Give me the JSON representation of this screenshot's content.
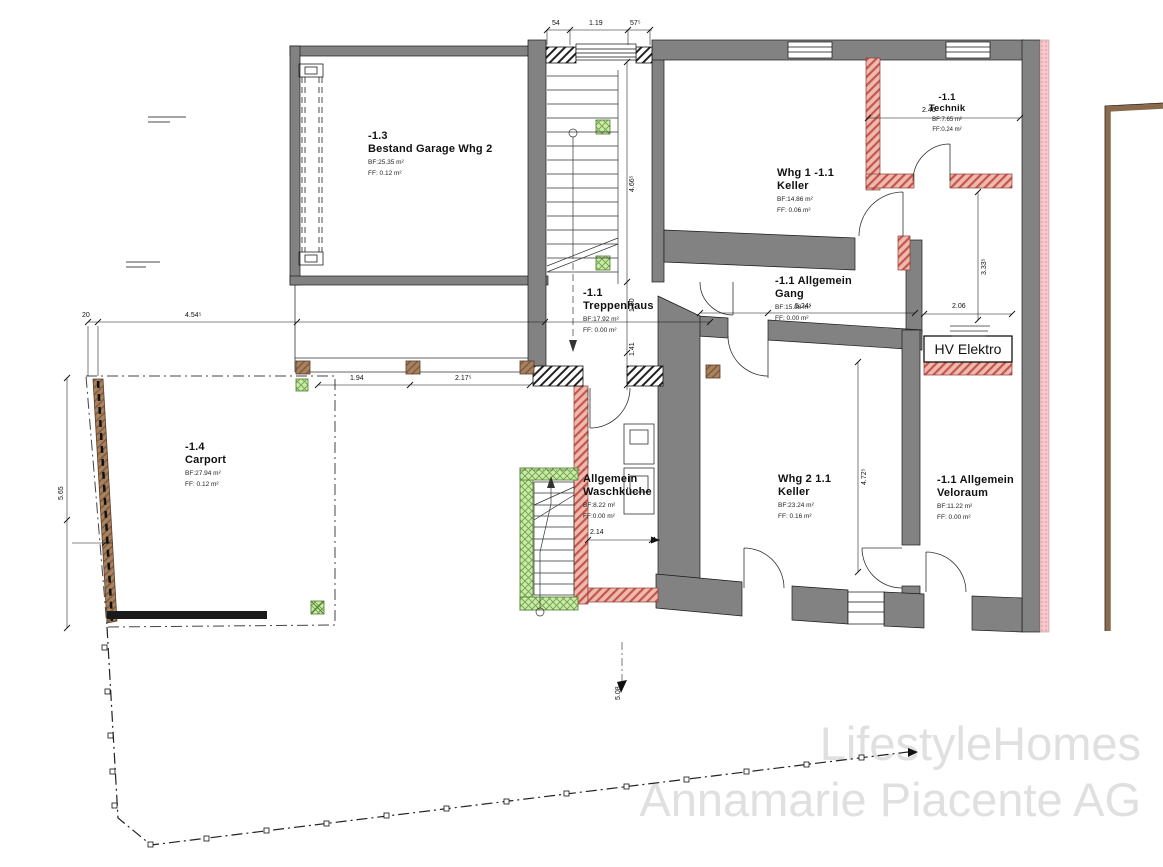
{
  "watermark": {
    "line1": "LifestyleHomes",
    "line2": "Annamarie Piacente AG"
  },
  "hv": {
    "label": "HV Elektro"
  },
  "rooms": [
    {
      "id": "-1.3",
      "name": "Bestand Garage Whg 2",
      "bf": "BF:25.35 m²",
      "ff": "FF: 0.12 m²"
    },
    {
      "id": "-1.1",
      "name": "Treppenhaus",
      "bf": "BF:17.92 m²",
      "ff": "FF: 0.00 m²"
    },
    {
      "id": "Whg 1 -1.1",
      "name": "Keller",
      "bf": "BF:14.86 m²",
      "ff": "FF: 0.06 m²"
    },
    {
      "id": "-1.1",
      "name": "Technik",
      "bf": "BF:7.65 m²",
      "ff": "FF:0.24 m²"
    },
    {
      "id": "-1.1 Allgemein",
      "name": "Gang",
      "bf": "BF:15.88 m²",
      "ff": "FF: 0.00 m²"
    },
    {
      "id": "Whg 2 1.1",
      "name": "Keller",
      "bf": "BF:23.24 m²",
      "ff": "FF: 0.16 m²"
    },
    {
      "id": "-1.1 Allgemein",
      "name": "Veloraum",
      "bf": "BF:11.22 m²",
      "ff": "FF: 0.00 m²"
    },
    {
      "id": "Allgemein",
      "name": "Waschküche",
      "bf": "BF:8.22 m²",
      "ff": "FF:0.00 m²"
    },
    {
      "id": "-1.4",
      "name": "Carport",
      "bf": "BF:27.94 m²",
      "ff": "FF: 0.12 m²"
    }
  ],
  "dims": [
    {
      "text": "54"
    },
    {
      "text": "1.19"
    },
    {
      "text": "57⁵"
    },
    {
      "text": "20"
    },
    {
      "text": "4.54⁵"
    },
    {
      "text": "1.94"
    },
    {
      "text": "2.17⁵"
    },
    {
      "text": "4.66⁵"
    },
    {
      "text": "1.50"
    },
    {
      "text": "1.41"
    },
    {
      "text": "2.46"
    },
    {
      "text": "3.33⁵"
    },
    {
      "text": "5.24⁵"
    },
    {
      "text": "2.06"
    },
    {
      "text": "2.14"
    },
    {
      "text": "4.72⁵"
    },
    {
      "text": "5.65"
    },
    {
      "text": "5.08"
    }
  ],
  "colors": {
    "wall_existing": "#828282",
    "wall_new_masonry": "#f0b9b0",
    "wall_new_wood": "#cde9a9",
    "wood": "#a8815f",
    "insulation": "#f6c9cd",
    "watermark": "#e0e0e0"
  }
}
